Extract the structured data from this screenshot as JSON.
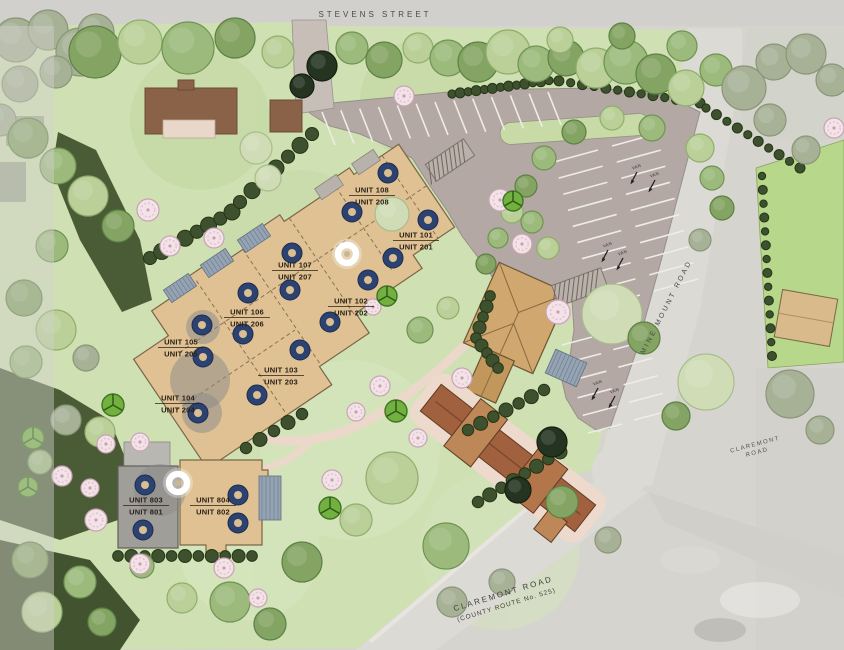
{
  "plan": {
    "title": "Site Plan",
    "streets": {
      "stevens": "STEVENS STREET",
      "mine_mount": "MINE MOUNT ROAD",
      "claremont_line1": "CLAREMONT ROAD",
      "claremont_line2": "(COUNTY ROUTE No. 525)",
      "claremont_side_line1": "CLAREMONT",
      "claremont_side_line2": "ROAD"
    },
    "parking_stall_label": "VAN",
    "units": [
      {
        "l1": "UNIT 108",
        "l2": "UNIT 208",
        "x": 372,
        "y": 195
      },
      {
        "l1": "UNIT 101",
        "l2": "UNIT 201",
        "x": 416,
        "y": 240
      },
      {
        "l1": "UNIT 107",
        "l2": "UNIT 207",
        "x": 295,
        "y": 270
      },
      {
        "l1": "UNIT 102",
        "l2": "UNIT 202",
        "x": 351,
        "y": 306
      },
      {
        "l1": "UNIT 106",
        "l2": "UNIT 206",
        "x": 247,
        "y": 317
      },
      {
        "l1": "UNIT 105",
        "l2": "UNIT 205",
        "x": 181,
        "y": 347
      },
      {
        "l1": "UNIT 103",
        "l2": "UNIT 203",
        "x": 281,
        "y": 375
      },
      {
        "l1": "UNIT 104",
        "l2": "UNIT 204",
        "x": 178,
        "y": 403
      },
      {
        "l1": "UNIT 803",
        "l2": "UNIT 801",
        "x": 146,
        "y": 505
      },
      {
        "l1": "UNIT 804",
        "l2": "UNIT 802",
        "x": 213,
        "y": 505
      }
    ],
    "colors": {
      "site_green": "#cfe0b2",
      "parking": "#b3a8a3",
      "building_tan": "#dfc193",
      "roof_brown": "#a2613e",
      "well_navy": "#2c4270",
      "road_gray": "#dcdad5",
      "walk_pink": "#ecd8ca",
      "patio_blue": "#96a3b2",
      "forest_dark": "#3d512e",
      "cube_green": "#72b040"
    },
    "palette": {
      "a": [
        "#9cba7c",
        "#6f9354"
      ],
      "b": [
        "#84a463",
        "#5d8045"
      ],
      "c": [
        "#bad098",
        "#8fae6e"
      ],
      "p": [
        "#cfdcb6",
        "#a9bd8c"
      ],
      "s": [
        "#a7b196",
        "#8a9579"
      ],
      "k": [
        "#3d512e",
        "#2c3d20"
      ],
      "x": [
        "#243420",
        "#15200f"
      ]
    },
    "trees": [
      [
        16,
        40,
        22,
        "s"
      ],
      [
        48,
        30,
        20,
        "s"
      ],
      [
        80,
        52,
        24,
        "s"
      ],
      [
        20,
        84,
        18,
        "s"
      ],
      [
        56,
        72,
        16,
        "s"
      ],
      [
        96,
        32,
        18,
        "s"
      ],
      [
        0,
        120,
        16,
        "s"
      ],
      [
        95,
        52,
        26,
        "b"
      ],
      [
        140,
        42,
        22,
        "c"
      ],
      [
        188,
        48,
        26,
        "a"
      ],
      [
        235,
        38,
        20,
        "b"
      ],
      [
        278,
        52,
        16,
        "c"
      ],
      [
        322,
        66,
        15,
        "x"
      ],
      [
        302,
        86,
        12,
        "x"
      ],
      [
        352,
        48,
        16,
        "a"
      ],
      [
        384,
        60,
        18,
        "b"
      ],
      [
        418,
        48,
        15,
        "c"
      ],
      [
        448,
        58,
        18,
        "a"
      ],
      [
        478,
        62,
        20,
        "b"
      ],
      [
        508,
        52,
        22,
        "c"
      ],
      [
        536,
        64,
        18,
        "a"
      ],
      [
        566,
        58,
        18,
        "b"
      ],
      [
        596,
        68,
        20,
        "c"
      ],
      [
        626,
        62,
        22,
        "a"
      ],
      [
        656,
        74,
        20,
        "b"
      ],
      [
        686,
        88,
        18,
        "c"
      ],
      [
        716,
        70,
        16,
        "a"
      ],
      [
        560,
        40,
        13,
        "c"
      ],
      [
        622,
        36,
        13,
        "b"
      ],
      [
        682,
        46,
        15,
        "a"
      ],
      [
        744,
        88,
        22,
        "s"
      ],
      [
        774,
        62,
        18,
        "s"
      ],
      [
        806,
        54,
        20,
        "s"
      ],
      [
        832,
        80,
        16,
        "s"
      ],
      [
        770,
        120,
        16,
        "s"
      ],
      [
        806,
        150,
        14,
        "s"
      ],
      [
        28,
        138,
        20,
        "b"
      ],
      [
        58,
        166,
        18,
        "a"
      ],
      [
        88,
        196,
        20,
        "c"
      ],
      [
        118,
        226,
        16,
        "b"
      ],
      [
        52,
        246,
        16,
        "a"
      ],
      [
        24,
        298,
        18,
        "b"
      ],
      [
        56,
        330,
        20,
        "c"
      ],
      [
        26,
        362,
        16,
        "a"
      ],
      [
        86,
        358,
        13,
        "s"
      ],
      [
        66,
        420,
        15,
        "s"
      ],
      [
        100,
        432,
        15,
        "c"
      ],
      [
        40,
        462,
        12,
        "a"
      ],
      [
        30,
        560,
        18,
        "b"
      ],
      [
        80,
        582,
        16,
        "a"
      ],
      [
        42,
        612,
        20,
        "c"
      ],
      [
        102,
        622,
        14,
        "b"
      ],
      [
        256,
        148,
        16,
        "p"
      ],
      [
        268,
        178,
        13,
        "p"
      ],
      [
        392,
        214,
        17,
        "p"
      ],
      [
        544,
        158,
        12,
        "a"
      ],
      [
        526,
        186,
        11,
        "b"
      ],
      [
        512,
        212,
        11,
        "c"
      ],
      [
        498,
        238,
        10,
        "a"
      ],
      [
        486,
        264,
        10,
        "b"
      ],
      [
        652,
        128,
        13,
        "a"
      ],
      [
        612,
        118,
        12,
        "c"
      ],
      [
        574,
        132,
        12,
        "b"
      ],
      [
        532,
        222,
        11,
        "a"
      ],
      [
        548,
        248,
        11,
        "c"
      ],
      [
        700,
        148,
        14,
        "c"
      ],
      [
        712,
        178,
        12,
        "a"
      ],
      [
        722,
        208,
        12,
        "b"
      ],
      [
        700,
        240,
        11,
        "s"
      ],
      [
        612,
        314,
        30,
        "p"
      ],
      [
        644,
        338,
        16,
        "b"
      ],
      [
        706,
        382,
        28,
        "p"
      ],
      [
        676,
        416,
        14,
        "b"
      ],
      [
        420,
        330,
        13,
        "a"
      ],
      [
        448,
        308,
        11,
        "c"
      ],
      [
        392,
        478,
        26,
        "c"
      ],
      [
        446,
        546,
        23,
        "a"
      ],
      [
        302,
        562,
        20,
        "b"
      ],
      [
        356,
        520,
        16,
        "c"
      ],
      [
        230,
        602,
        20,
        "a"
      ],
      [
        270,
        624,
        16,
        "b"
      ],
      [
        182,
        598,
        15,
        "c"
      ],
      [
        142,
        566,
        12,
        "a"
      ],
      [
        452,
        602,
        15,
        "s"
      ],
      [
        502,
        582,
        13,
        "s"
      ],
      [
        562,
        502,
        16,
        "b"
      ],
      [
        608,
        540,
        13,
        "s"
      ],
      [
        552,
        442,
        15,
        "x"
      ],
      [
        518,
        490,
        13,
        "x"
      ],
      [
        790,
        394,
        24,
        "s"
      ],
      [
        820,
        430,
        14,
        "s"
      ]
    ],
    "pink_trees": [
      [
        148,
        210,
        11
      ],
      [
        170,
        246,
        10
      ],
      [
        214,
        238,
        10
      ],
      [
        404,
        96,
        10
      ],
      [
        500,
        200,
        11
      ],
      [
        522,
        244,
        10
      ],
      [
        558,
        312,
        12
      ],
      [
        373,
        307,
        8
      ],
      [
        380,
        386,
        10
      ],
      [
        356,
        412,
        9
      ],
      [
        462,
        378,
        10
      ],
      [
        332,
        480,
        10
      ],
      [
        418,
        438,
        9
      ],
      [
        96,
        520,
        11
      ],
      [
        62,
        476,
        10
      ],
      [
        106,
        444,
        9
      ],
      [
        140,
        442,
        9
      ],
      [
        90,
        488,
        9
      ],
      [
        140,
        564,
        10
      ],
      [
        224,
        568,
        10
      ],
      [
        258,
        598,
        9
      ],
      [
        834,
        128,
        10
      ]
    ],
    "cubes": [
      [
        113,
        405,
        11
      ],
      [
        33,
        438,
        11
      ],
      [
        28,
        487,
        10
      ],
      [
        330,
        508,
        11
      ],
      [
        396,
        411,
        11
      ],
      [
        387,
        296,
        10
      ],
      [
        513,
        201,
        10
      ]
    ],
    "wells_blue": [
      [
        388,
        173
      ],
      [
        352,
        212
      ],
      [
        428,
        220
      ],
      [
        393,
        258
      ],
      [
        292,
        253
      ],
      [
        248,
        293
      ],
      [
        290,
        290
      ],
      [
        368,
        280
      ],
      [
        330,
        322
      ],
      [
        243,
        334
      ],
      [
        202,
        325
      ],
      [
        203,
        357
      ],
      [
        300,
        350
      ],
      [
        257,
        395
      ],
      [
        198,
        413
      ],
      [
        145,
        485
      ],
      [
        238,
        495
      ],
      [
        143,
        530
      ],
      [
        238,
        523
      ]
    ],
    "wells_white": [
      [
        347,
        254
      ],
      [
        178,
        483
      ]
    ],
    "halos": [
      [
        200,
        380,
        30
      ],
      [
        160,
        490,
        26
      ],
      [
        202,
        413,
        20
      ],
      [
        203,
        327,
        17
      ]
    ],
    "shrub_rows": [
      {
        "pts": [
          [
            452,
            94
          ],
          [
            553,
            80
          ],
          [
            700,
            103
          ]
        ],
        "n": 26,
        "r": 5
      },
      {
        "pts": [
          [
            706,
            108
          ],
          [
            800,
            168
          ]
        ],
        "n": 10,
        "r": 5
      },
      {
        "pts": [
          [
            762,
            176
          ],
          [
            772,
            356
          ]
        ],
        "n": 14,
        "r": 4.5
      },
      {
        "pts": [
          [
            150,
            258
          ],
          [
            232,
            212
          ]
        ],
        "n": 8,
        "r": 8
      },
      {
        "pts": [
          [
            240,
            202
          ],
          [
            312,
            134
          ]
        ],
        "n": 7,
        "r": 8
      },
      {
        "pts": [
          [
            490,
            296
          ],
          [
            476,
            338
          ],
          [
            498,
            368
          ]
        ],
        "n": 9,
        "r": 6.5
      },
      {
        "pts": [
          [
            468,
            430
          ],
          [
            544,
            390
          ]
        ],
        "n": 7,
        "r": 7
      },
      {
        "pts": [
          [
            478,
            502
          ],
          [
            560,
            452
          ]
        ],
        "n": 8,
        "r": 7
      },
      {
        "pts": [
          [
            118,
            556
          ],
          [
            252,
            556
          ]
        ],
        "n": 11,
        "r": 6.5
      },
      {
        "pts": [
          [
            246,
            448
          ],
          [
            302,
            414
          ]
        ],
        "n": 5,
        "r": 7
      }
    ],
    "stall_groups": [
      {
        "x1": 322,
        "y1": 112,
        "x2": 548,
        "y2": 92,
        "n": 13,
        "dx": 13,
        "dy": 33
      },
      {
        "x1": 598,
        "y1": 150,
        "x2": 640,
        "y2": 295,
        "n": 10,
        "dx": -44,
        "dy": 12
      },
      {
        "x1": 612,
        "y1": 146,
        "x2": 654,
        "y2": 291,
        "n": 10,
        "dx": 44,
        "dy": -12
      },
      {
        "x1": 596,
        "y1": 336,
        "x2": 622,
        "y2": 424,
        "n": 6,
        "dx": -34,
        "dy": 9
      },
      {
        "x1": 608,
        "y1": 332,
        "x2": 634,
        "y2": 420,
        "n": 6,
        "dx": 34,
        "dy": -9
      }
    ],
    "van_markers": [
      [
        637,
        172
      ],
      [
        655,
        180
      ],
      [
        608,
        250
      ],
      [
        623,
        258
      ],
      [
        598,
        388
      ],
      [
        615,
        396
      ]
    ],
    "crosswalks": [
      {
        "x": 450,
        "y": 160,
        "w": 46,
        "h": 20,
        "rot": -34
      },
      {
        "x": 580,
        "y": 287,
        "w": 52,
        "h": 22,
        "rot": -20
      }
    ],
    "patios": [
      {
        "x": 180,
        "y": 288,
        "w": 30,
        "h": 15,
        "rot": -34,
        "v": "b"
      },
      {
        "x": 217,
        "y": 263,
        "w": 30,
        "h": 15,
        "rot": -34,
        "v": "b"
      },
      {
        "x": 254,
        "y": 238,
        "w": 30,
        "h": 15,
        "rot": -34,
        "v": "b"
      },
      {
        "x": 329,
        "y": 187,
        "w": 26,
        "h": 13,
        "rot": -34,
        "v": "g"
      },
      {
        "x": 366,
        "y": 162,
        "w": 26,
        "h": 13,
        "rot": -34,
        "v": "g"
      },
      {
        "x": 270,
        "y": 498,
        "w": 22,
        "h": 44,
        "rot": 0,
        "v": "b"
      },
      {
        "x": 566,
        "y": 368,
        "w": 34,
        "h": 26,
        "rot": 24,
        "v": "b"
      }
    ]
  }
}
